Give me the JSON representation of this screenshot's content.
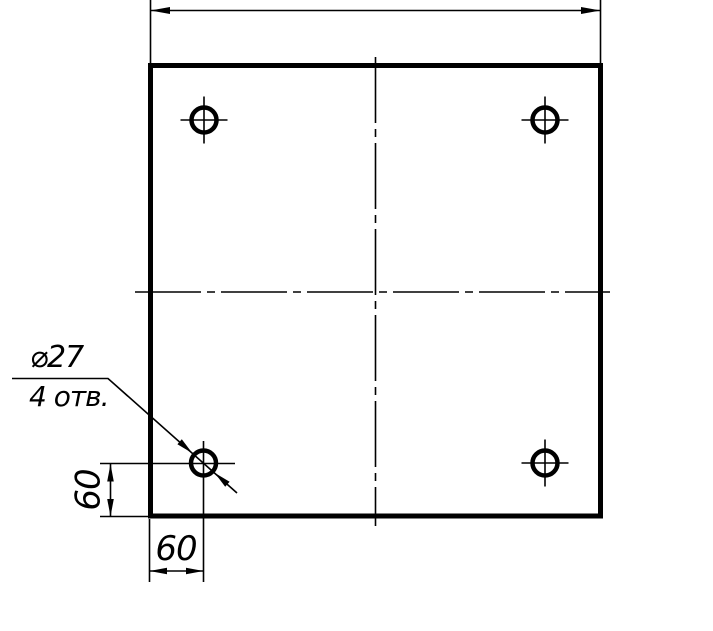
{
  "drawing": {
    "callout": {
      "line1": "⌀27",
      "line2": "4 отв."
    },
    "dims": {
      "vertical_offset": "60",
      "horizontal_offset": "60"
    },
    "holes": {
      "count": 4,
      "diameter": 27,
      "offset_from_left_edge": 60,
      "offset_from_bottom_edge": 60
    },
    "colors": {
      "line": "#000000",
      "background": "#ffffff"
    }
  }
}
